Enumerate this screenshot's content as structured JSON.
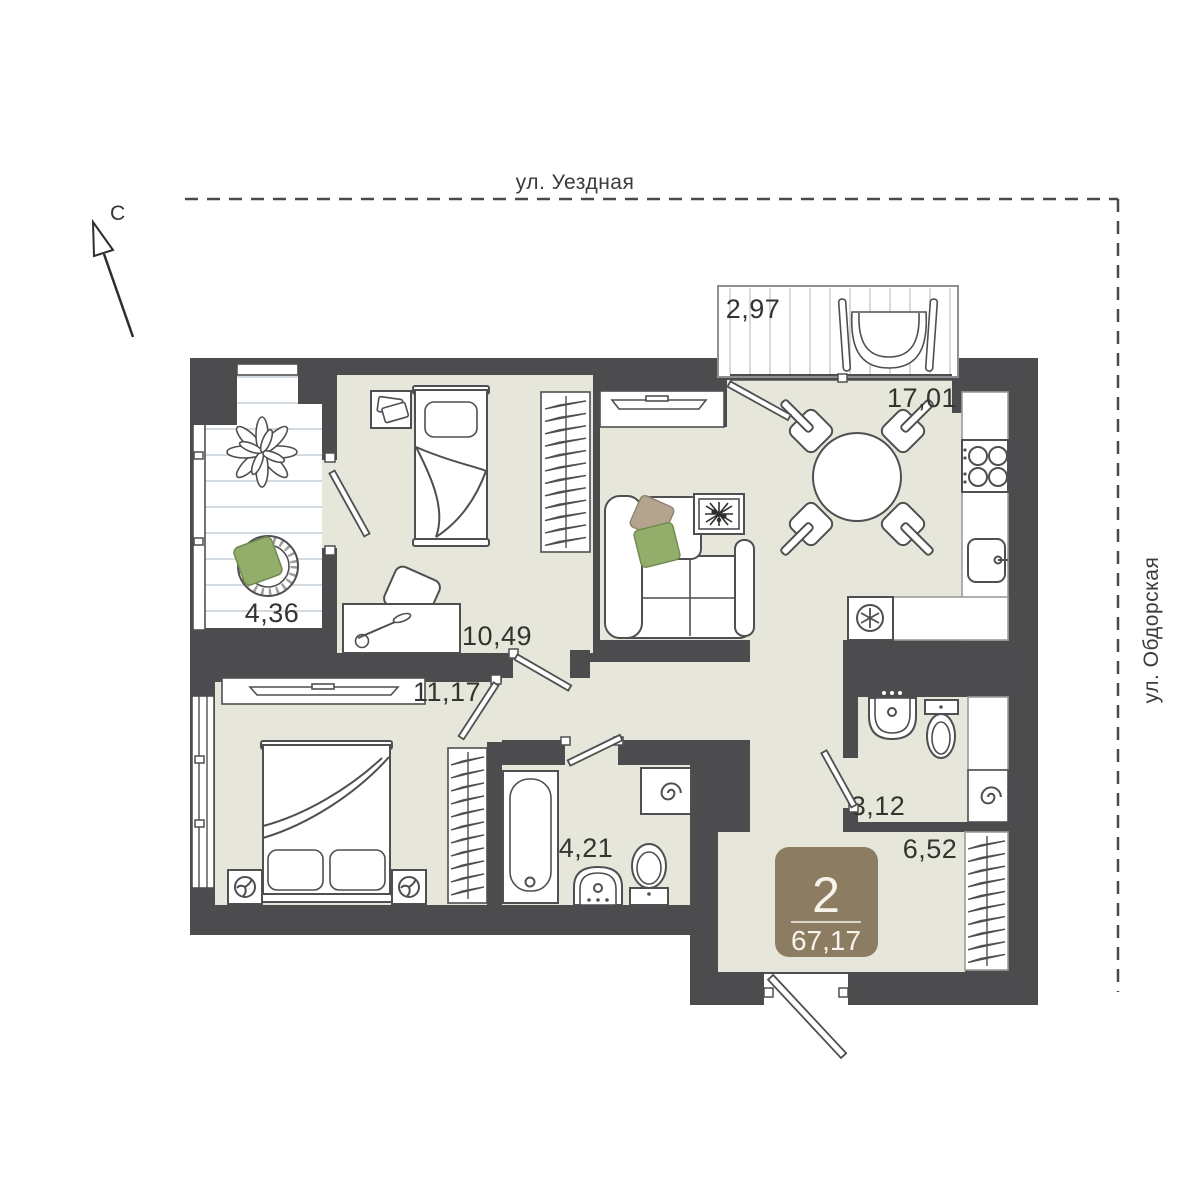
{
  "streets": {
    "top": "ул. Уездная",
    "right": "ул. Обдорская"
  },
  "compass": {
    "north_label": "С"
  },
  "apartment": {
    "badge": {
      "rooms_count": "2",
      "total_area": "67,17"
    },
    "rooms": [
      {
        "id": "balcony-top",
        "label": "2,97"
      },
      {
        "id": "kitchen-living",
        "label": "17,01"
      },
      {
        "id": "balcony-left",
        "label": "4,36"
      },
      {
        "id": "bedroom-small",
        "label": "10,49"
      },
      {
        "id": "bedroom-master",
        "label": "11,17"
      },
      {
        "id": "bathroom",
        "label": "4,21"
      },
      {
        "id": "wc",
        "label": "3,12"
      },
      {
        "id": "hallway",
        "label": "6,52"
      }
    ]
  },
  "colors": {
    "wall": "#4c4c4e",
    "floor": "#e6e6da",
    "badge": "#8c7c61",
    "badge_text": "#f7f3ea",
    "cushion_green": "#93ad6b",
    "cushion_tan": "#b4a48d",
    "balcony_stripe": "#d3dae0",
    "line": "#4f4f51",
    "street_text": "#3b3b3d"
  }
}
